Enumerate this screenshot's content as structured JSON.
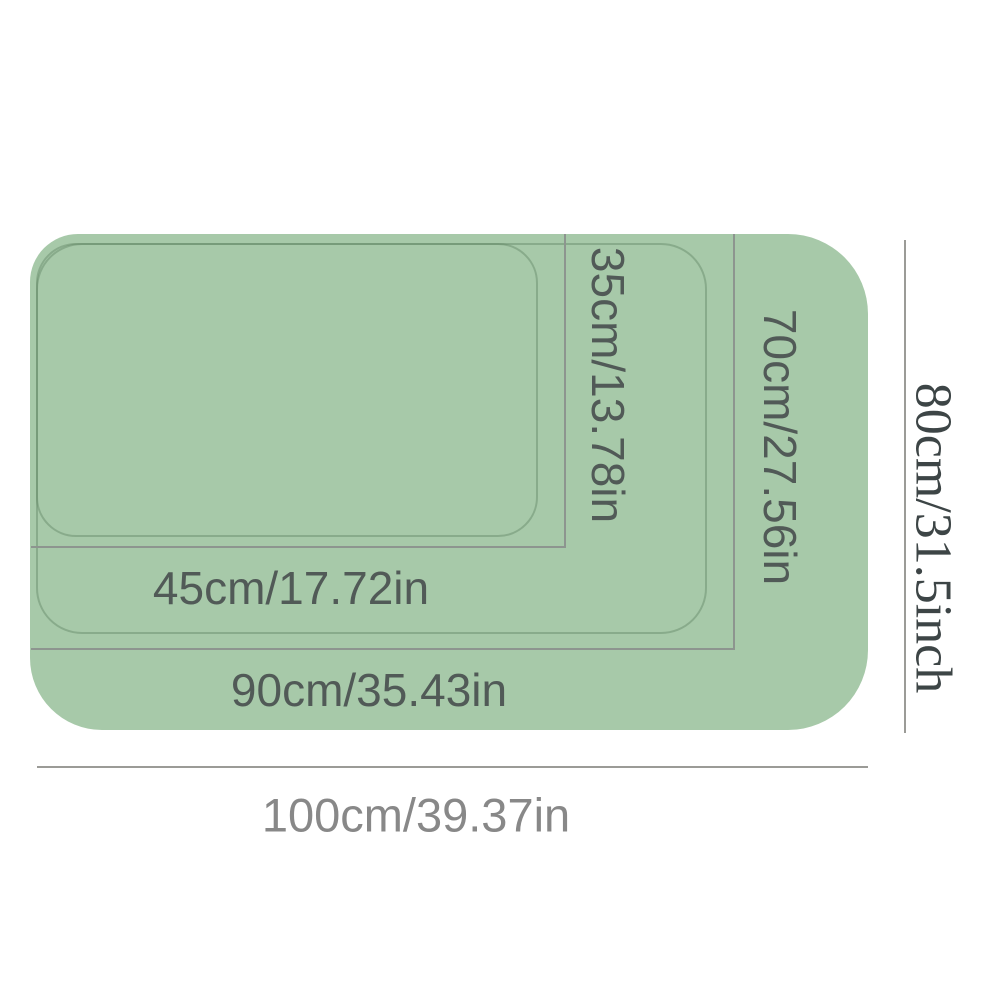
{
  "diagram": {
    "type": "product-size-diagram",
    "description": "Nested rounded-rectangle mat sizes aligned at top-left, with width and height dimension labels",
    "sizes": [
      {
        "id": "small",
        "width_label": "45cm/17.72in",
        "height_label": "35cm/13.78in"
      },
      {
        "id": "medium",
        "width_label": "90cm/35.43in",
        "height_label": "70cm/27.56in"
      },
      {
        "id": "large",
        "width_label": "100cm/39.37in",
        "height_label": "80cm/31.5inch"
      }
    ]
  },
  "colors": {
    "mat_fill": "#a7c9a9",
    "mat_border_line": "#8d958f",
    "emboss_line": "#93b795",
    "label_on_mat": "#515a57",
    "label_bottom": "#888888",
    "label_right": "#3d4546",
    "measure_line": "#9b9b97",
    "background": "#ffffff"
  }
}
